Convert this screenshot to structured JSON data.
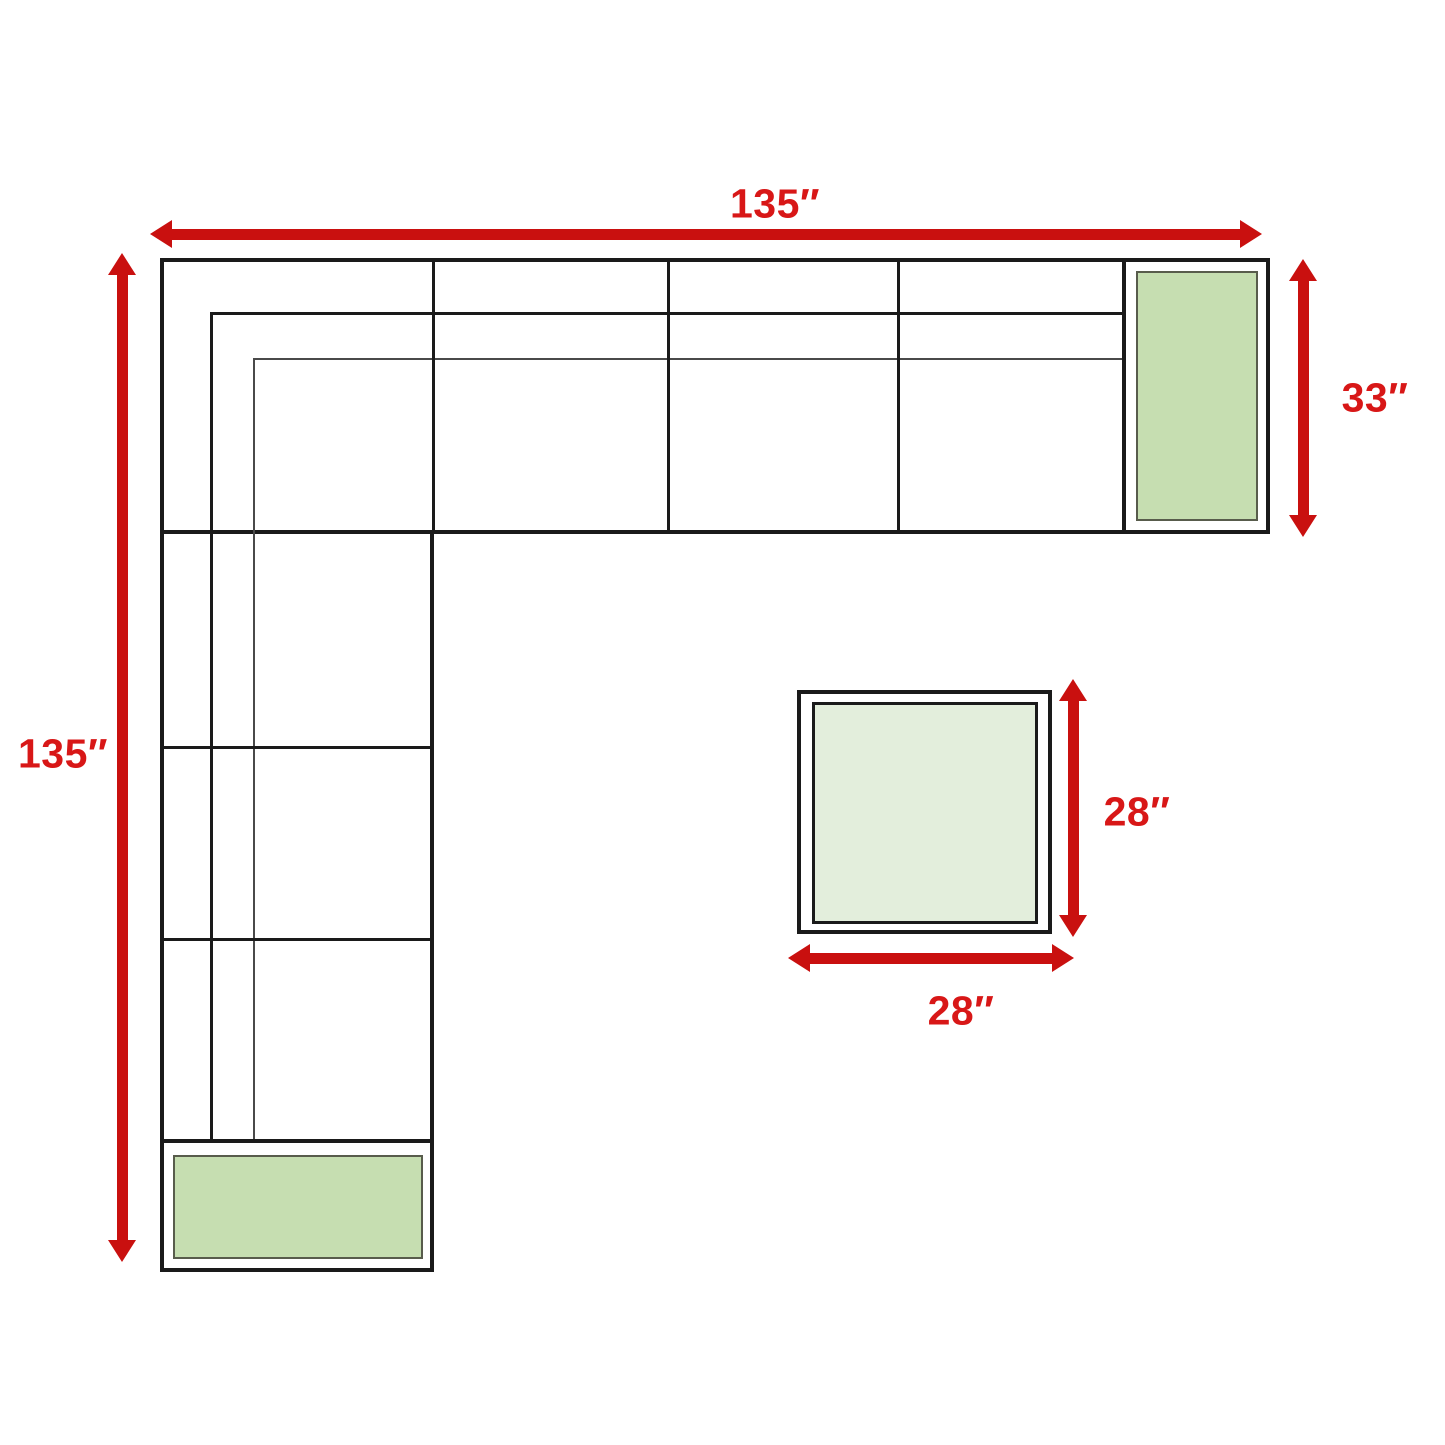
{
  "diagram": {
    "title": "Sectional sofa with ottoman dimension diagram",
    "sofa": {
      "width_label": "135″",
      "depth_label": "135″",
      "right_end_depth_label": "33″",
      "pieces": [
        "corner-section",
        "armless-seat-1",
        "armless-seat-2",
        "armless-seat-3",
        "right-end-cushion",
        "left-seat-1",
        "left-seat-2",
        "left-seat-3",
        "bottom-end-cushion"
      ]
    },
    "ottoman": {
      "depth_label": "28″",
      "width_label": "28″"
    },
    "colors": {
      "arrow_red": "#c9100f",
      "label_red": "#d81717",
      "outline_black": "#1a1a1a",
      "thin_seam_gray": "#4a4a4a",
      "cushion_green": "#c6deb1",
      "cushion_border_green": "#585c4c",
      "ottoman_green": "#e3eedc",
      "background": "#ffffff"
    }
  }
}
